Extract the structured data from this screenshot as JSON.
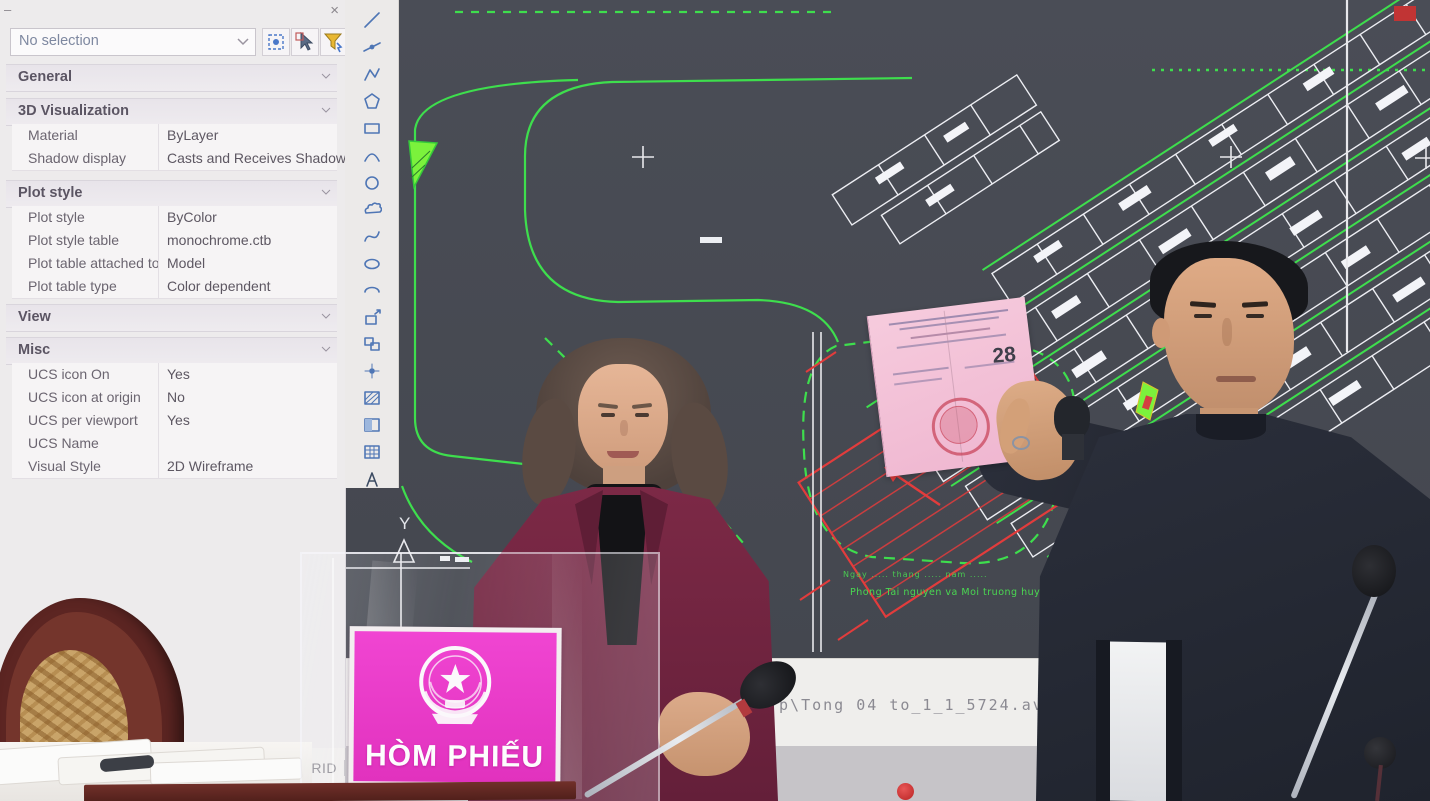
{
  "palette": {
    "minimize_glyph": "–",
    "close_glyph": "×",
    "selection_value": "No selection",
    "sections": {
      "general": {
        "label": "General"
      },
      "vis3d": {
        "label": "3D Visualization",
        "rows": [
          {
            "label": "Material",
            "value": "ByLayer"
          },
          {
            "label": "Shadow display",
            "value": "Casts and Receives Shadows"
          }
        ]
      },
      "plot": {
        "label": "Plot style",
        "rows": [
          {
            "label": "Plot style",
            "value": "ByColor"
          },
          {
            "label": "Plot style table",
            "value": "monochrome.ctb"
          },
          {
            "label": "Plot table attached to",
            "value": "Model"
          },
          {
            "label": "Plot table type",
            "value": "Color dependent"
          }
        ]
      },
      "view": {
        "label": "View"
      },
      "misc": {
        "label": "Misc",
        "rows": [
          {
            "label": "UCS icon On",
            "value": "Yes"
          },
          {
            "label": "UCS icon at origin",
            "value": "No"
          },
          {
            "label": "UCS per viewport",
            "value": "Yes"
          },
          {
            "label": "UCS Name",
            "value": ""
          },
          {
            "label": "Visual Style",
            "value": "2D Wireframe"
          }
        ]
      }
    }
  },
  "toolbar": {
    "icons": [
      "line",
      "construction-line",
      "polyline",
      "polygon",
      "rectangle",
      "arc",
      "circle",
      "revision-cloud",
      "spline",
      "ellipse",
      "ellipse-arc",
      "insert-block",
      "make-block",
      "point",
      "hatch",
      "gradient",
      "table",
      "multiline-text"
    ]
  },
  "statusbar": {
    "items": [
      "SNAP",
      "GRID"
    ]
  },
  "screen": {
    "command_text": "rp\\Tong 04 to_1_1_5724.av$ ...",
    "ucs_axis": "Y",
    "note_line1": "Ngay ..... thang ..... nam .....",
    "note_line2": "Phong Tai nguyen va Moi truong huyen Hoai Duc",
    "colors": {
      "background": "#474a52",
      "line_green": "#3ede4d",
      "line_white": "#edeef3",
      "line_red": "#e23c3c"
    }
  },
  "ballot_box": {
    "sign_text": "HÒM PHIẾU",
    "sign_pink": "#ea3bce"
  },
  "ballot_paper": {
    "number": "28"
  }
}
